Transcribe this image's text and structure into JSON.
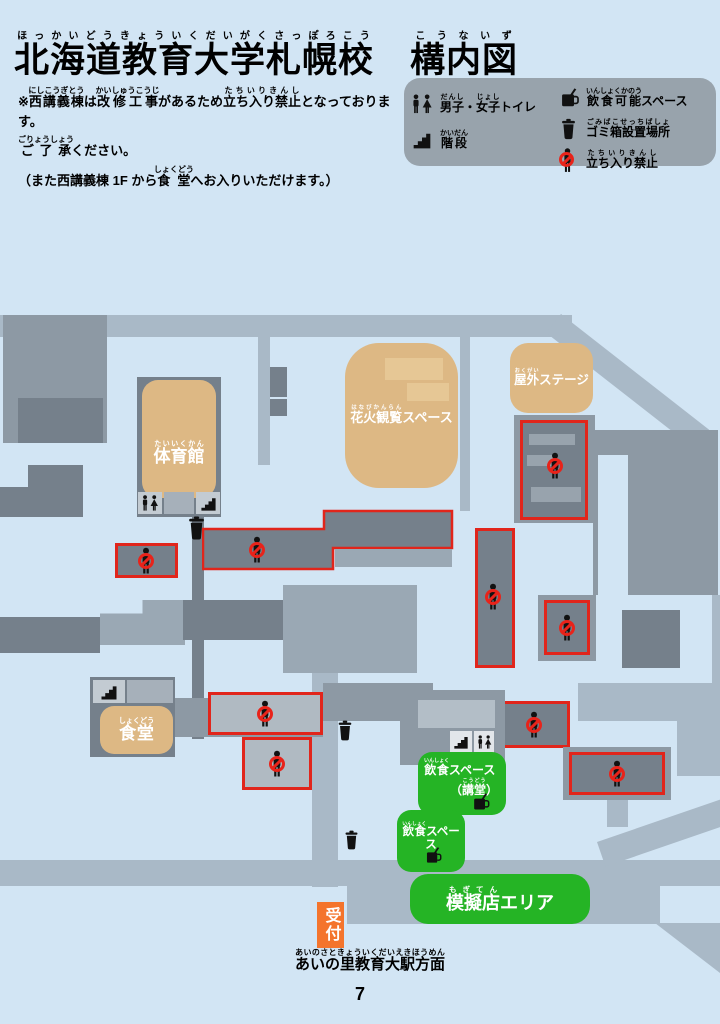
{
  "title": {
    "segments": [
      {
        "t": "北海道教育大学札幌校",
        "r": "ほっかいどうきょういくだいがくさっぽろこう"
      },
      {
        "t": "　"
      },
      {
        "t": "構内図",
        "r": "こうないず"
      }
    ]
  },
  "notice": {
    "line1": [
      {
        "t": "※"
      },
      {
        "t": "西講義棟",
        "r": "にしこうぎとう"
      },
      {
        "t": "は"
      },
      {
        "t": "改修工事",
        "r": "かいしゅうこうじ"
      },
      {
        "t": "があるため"
      },
      {
        "t": "立ち入り禁止",
        "r": "たちいりきんし"
      },
      {
        "t": "となっております。"
      }
    ],
    "line2": [
      {
        "t": "ご了承",
        "r": "ごりょうしょう"
      },
      {
        "t": "ください。"
      }
    ],
    "line3": [
      {
        "t": "（また西講義棟 1F から"
      },
      {
        "t": "食堂",
        "r": "しょくどう"
      },
      {
        "t": "へお入りいただけます。）"
      }
    ]
  },
  "legend": {
    "items": [
      {
        "icon": "toilet-icon",
        "label": [
          {
            "t": "男子",
            "r": "だんし"
          },
          {
            "t": "・"
          },
          {
            "t": "女子",
            "r": "じょし"
          },
          {
            "t": "トイレ"
          }
        ]
      },
      {
        "icon": "stairs-icon",
        "label": [
          {
            "t": "階段",
            "r": "かいだん"
          }
        ]
      },
      {
        "icon": "food-icon",
        "label": [
          {
            "t": "飲食可能",
            "r": "いんしょくかのう"
          },
          {
            "t": "スペース"
          }
        ]
      },
      {
        "icon": "trash-icon",
        "label": [
          {
            "t": "ゴミ箱設置場所",
            "r": "ごみばこせっちばしょ"
          }
        ]
      },
      {
        "icon": "no-entry-icon",
        "label": [
          {
            "t": "立ち入り禁止",
            "r": "たちいりきんし"
          }
        ]
      }
    ]
  },
  "map": {
    "labels": {
      "gym": [
        {
          "t": "体育館",
          "r": "たいいくかん"
        }
      ],
      "fireworks": [
        {
          "t": "花火観覧",
          "r": "はなびかんらん"
        },
        {
          "t": "スペース"
        }
      ],
      "stage": [
        {
          "t": "屋外",
          "r": "おくがい"
        },
        {
          "t": "ステージ"
        }
      ],
      "cafeteria": [
        {
          "t": "食堂",
          "r": "しょくどう"
        }
      ],
      "eatery_hall_line1": [
        {
          "t": "飲食",
          "r": "いんしょく"
        },
        {
          "t": "スペース"
        }
      ],
      "eatery_hall_line2": [
        {
          "t": "（"
        },
        {
          "t": "講堂",
          "r": "こうどう"
        },
        {
          "t": "）"
        }
      ],
      "eatery": [
        {
          "t": "飲食",
          "r": "いんしょく"
        },
        {
          "t": "スペース"
        }
      ],
      "booth_area": [
        {
          "t": "模擬店",
          "r": "もぎてん"
        },
        {
          "t": "エリア"
        }
      ],
      "reception": "受付",
      "station": [
        {
          "t": "あいの里教育大駅方面",
          "r": "あいのさときょういくだいえきほうめん"
        }
      ]
    },
    "page_number": "7"
  },
  "colors": {
    "background": "#d2e5f4",
    "road": "#a9b9c7",
    "building": "#8d99a4",
    "building_dark": "#75808b",
    "building_light": "#b0bac2",
    "area_tan": "#ddb884",
    "area_green": "#25b425",
    "restricted_red": "#e1251b",
    "reception_orange": "#f4742c"
  },
  "icons": {
    "toilet": "toilet-icon",
    "stairs": "stairs-icon",
    "food": "food-icon",
    "trash": "trash-icon",
    "no_entry": "no-entry-icon"
  }
}
